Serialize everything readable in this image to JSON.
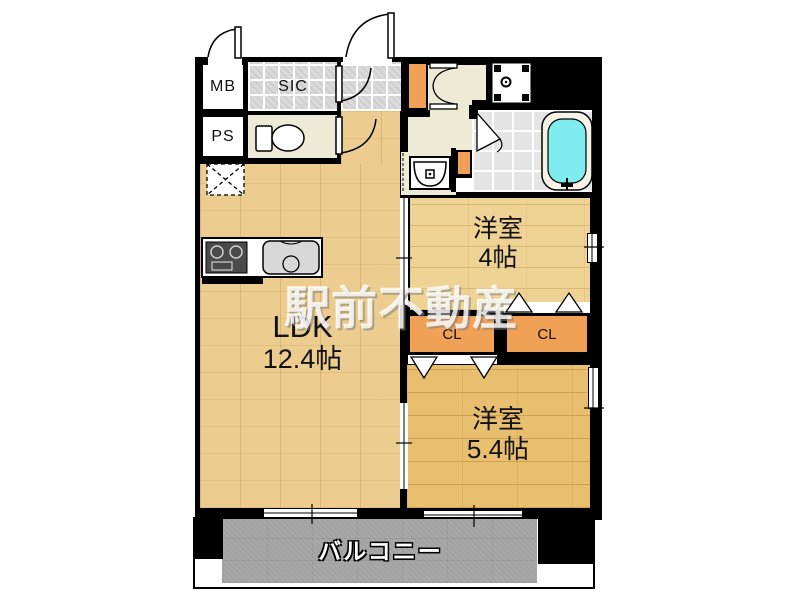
{
  "plan_title": "apartment-floor-plan",
  "watermark": {
    "text": "駅前不動産"
  },
  "rooms": {
    "mb": {
      "label": "MB"
    },
    "ps": {
      "label": "PS"
    },
    "sic": {
      "label": "SIC"
    },
    "ldk": {
      "name": "LDK",
      "size": "12.4帖"
    },
    "west4": {
      "name": "洋室",
      "size": "4帖"
    },
    "west5": {
      "name": "洋室",
      "size": "5.4帖"
    },
    "closet_a": {
      "label": "CL"
    },
    "closet_b": {
      "label": "CL"
    },
    "balcony": {
      "label": "バルコニー"
    }
  },
  "fixtures": [
    "entrance-door-swing",
    "mb-door-swing",
    "sic-door-swing",
    "toilet-door-swing",
    "hall-double-door",
    "bathroom-folding-door",
    "closet-folding-doors",
    "toilet-fixture",
    "washbasin",
    "washing-machine-pan",
    "bathtub",
    "kitchen-counter",
    "gas-stove",
    "kitchen-sink",
    "refrigerator-space"
  ],
  "colors": {
    "wall": "#000000",
    "wood_ldk": "#ECCD8F",
    "wood_west4": "#EFD394",
    "wood_west5": "#E8BF6F",
    "closet_orange": "#F0A155",
    "hallway_cream": "#EDEAD6",
    "tile_gray": "#DADADA",
    "bathtub_cyan": "#7FEDEF",
    "balcony_gray": "#A2A2A2"
  }
}
